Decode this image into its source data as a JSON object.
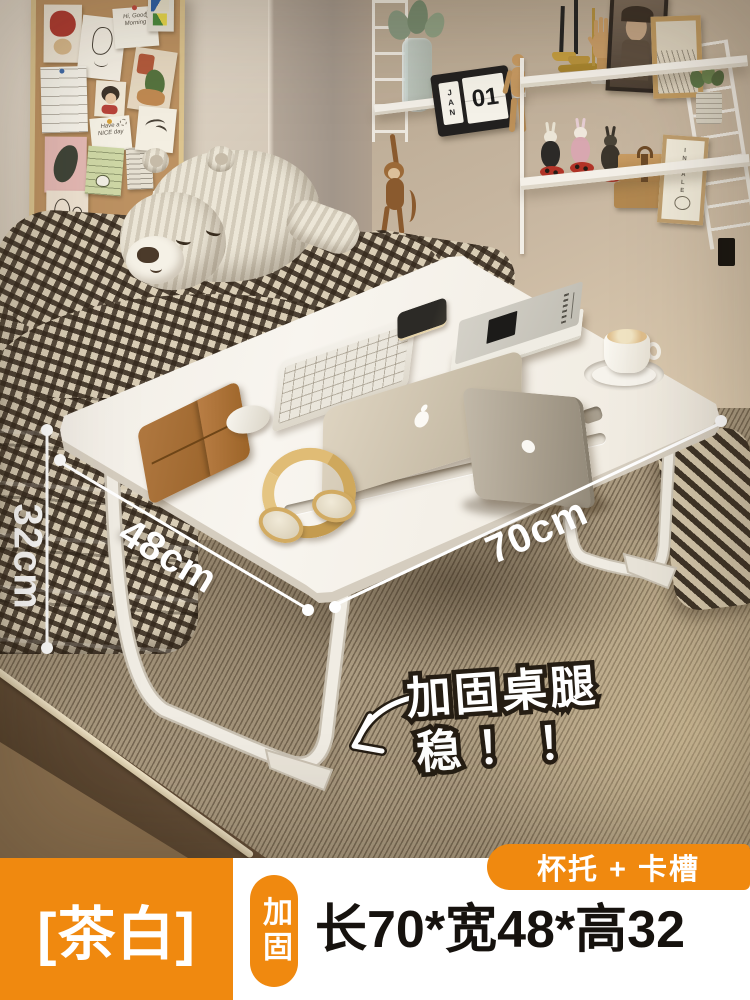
{
  "overlay": {
    "dim_height": "32cm",
    "dim_width": "48cm",
    "dim_length": "70cm",
    "callout_line1": "加固桌腿",
    "callout_line2": "稳！！"
  },
  "banner": {
    "variant": "[茶白]",
    "badge": "加固",
    "size": "长70*宽48*高32",
    "feature": "杯托 + 卡槽",
    "orange": "#F0890F"
  },
  "scene": {
    "calendar_month": "JAN",
    "calendar_day": "01",
    "morning_note_line1": "Hi, Good",
    "morning_note_line2": "Morning",
    "day_note_line1": "Have a",
    "day_note_line2": "NICE day",
    "inhale_card": "INHALE"
  }
}
